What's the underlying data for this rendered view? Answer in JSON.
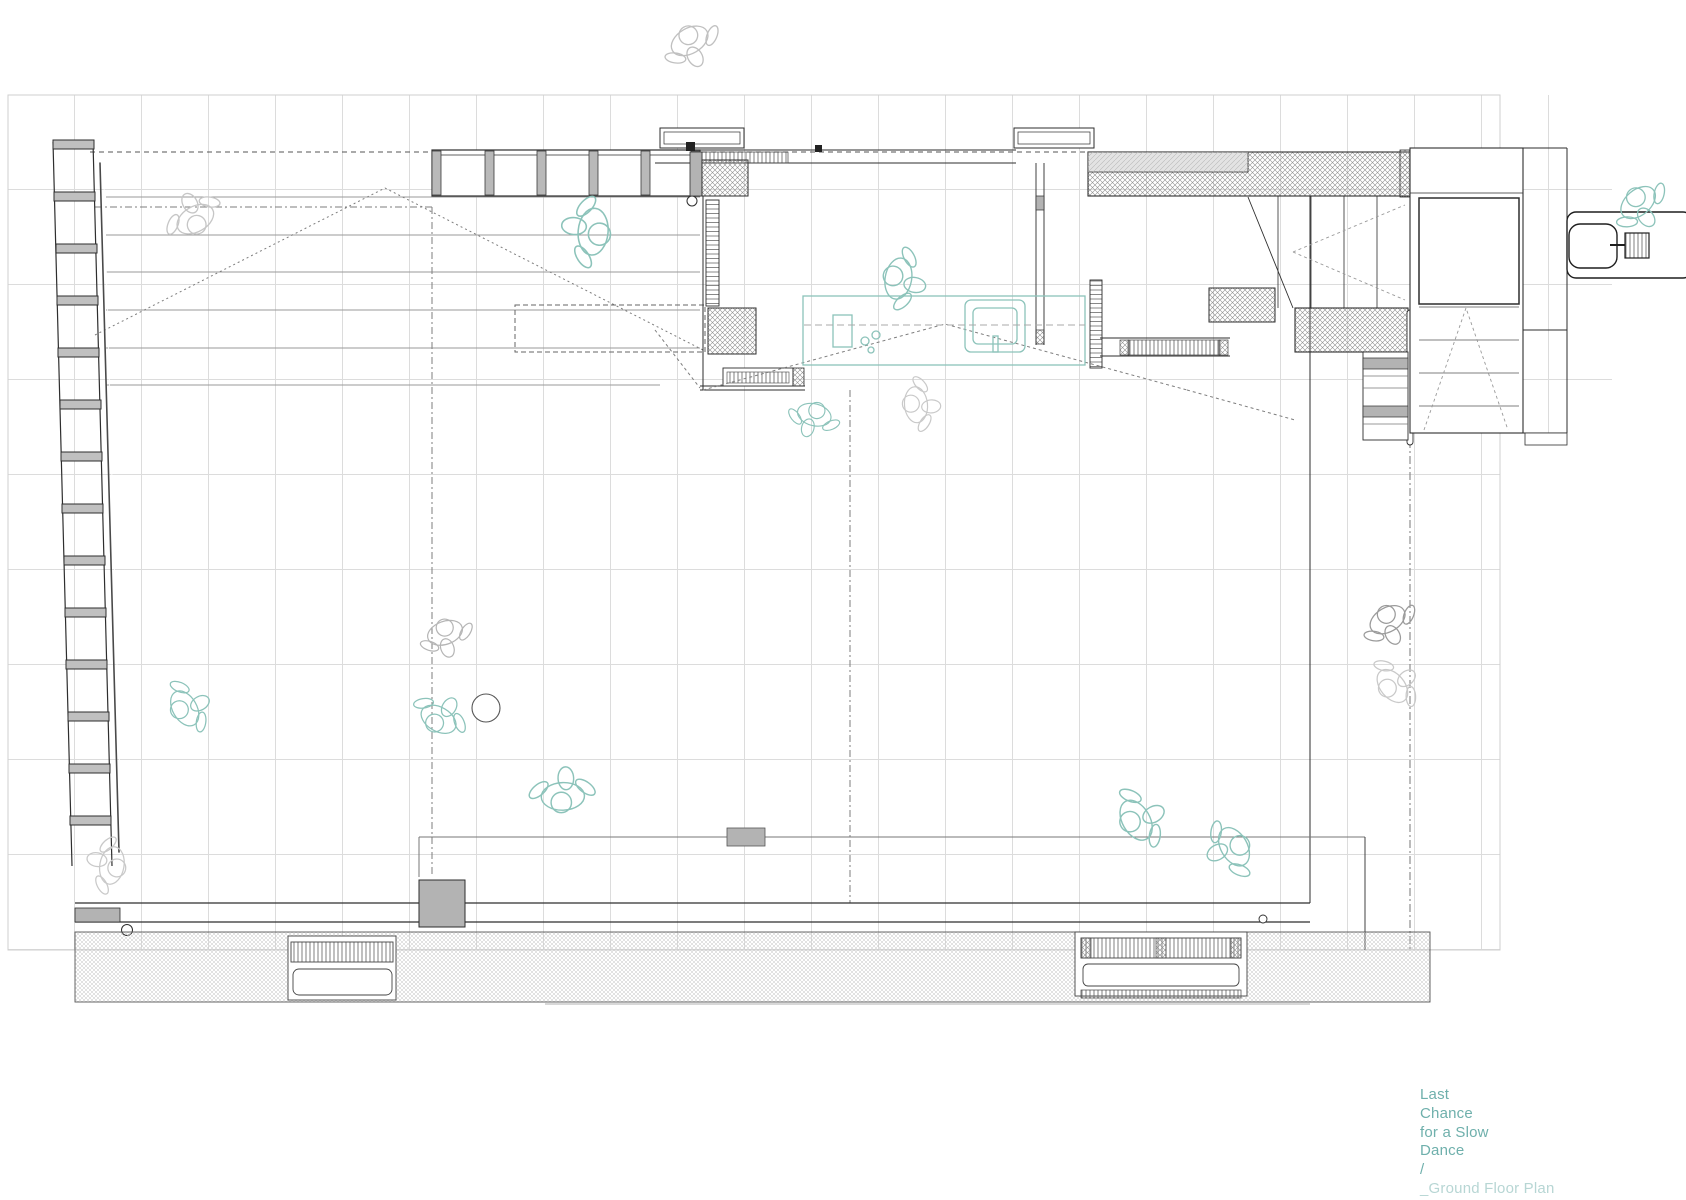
{
  "title_block": {
    "lines": [
      "Last",
      "Chance",
      "for a Slow",
      "Dance",
      "/",
      "_Ground Floor Plan"
    ],
    "accent_color": "#6fb0ac",
    "muted_color": "#b7d6d4"
  },
  "palette": {
    "figure_teal": "#8cc3ba",
    "figure_gray_dark": "#9b9b9b",
    "figure_gray": "#b5b5b5",
    "figure_gray_light": "#c9c9c9",
    "wall_gray_fill": "#b3b3b3",
    "grid_line": "#dcdcdc"
  },
  "plan": {
    "kind": "architectural-ground-floor-plan",
    "ball": {
      "x": 486,
      "y": 708,
      "r": 14
    },
    "figures": [
      {
        "id": "passerby-top",
        "x": 688,
        "y": 38,
        "rot": -30,
        "scale": 1.1,
        "color": "#c0c0c0"
      },
      {
        "id": "terrace-walker",
        "x": 197,
        "y": 222,
        "rot": 150,
        "scale": 1.1,
        "color": "#c6c6c6"
      },
      {
        "id": "dancer-top-left",
        "x": 597,
        "y": 232,
        "rot": 95,
        "scale": 1.3,
        "color": "#8cc3ba"
      },
      {
        "id": "person-at-bar",
        "x": 895,
        "y": 278,
        "rot": -80,
        "scale": 1.15,
        "color": "#8cc3ba"
      },
      {
        "id": "crouching-person",
        "x": 815,
        "y": 412,
        "rot": 15,
        "scale": 0.95,
        "color": "#8cc3ba"
      },
      {
        "id": "gray-partner",
        "x": 913,
        "y": 405,
        "rot": -95,
        "scale": 1.0,
        "color": "#c9c9c9"
      },
      {
        "id": "gray-dancer-mid",
        "x": 444,
        "y": 630,
        "rot": -20,
        "scale": 1.0,
        "color": "#b5b5b5"
      },
      {
        "id": "teal-dancer-mid",
        "x": 437,
        "y": 722,
        "rot": -150,
        "scale": 1.05,
        "color": "#8cc3ba"
      },
      {
        "id": "teal-dancer-left",
        "x": 182,
        "y": 710,
        "rot": -120,
        "scale": 1.05,
        "color": "#8cc3ba"
      },
      {
        "id": "sitting-on-bench",
        "x": 563,
        "y": 800,
        "rot": 178,
        "scale": 1.2,
        "color": "#8cc3ba"
      },
      {
        "id": "gray-corner-person",
        "x": 115,
        "y": 866,
        "rot": 100,
        "scale": 1.05,
        "color": "#c9c9c9"
      },
      {
        "id": "dancing-pair-a",
        "x": 1133,
        "y": 822,
        "rot": -120,
        "scale": 1.2,
        "color": "#8cc3ba"
      },
      {
        "id": "dancing-pair-b",
        "x": 1237,
        "y": 845,
        "rot": 60,
        "scale": 1.15,
        "color": "#8cc3ba"
      },
      {
        "id": "sidewalk-person-a",
        "x": 1386,
        "y": 617,
        "rot": -30,
        "scale": 1.05,
        "color": "#9b9b9b"
      },
      {
        "id": "sidewalk-person-b",
        "x": 1390,
        "y": 688,
        "rot": -130,
        "scale": 1.05,
        "color": "#c9c9c9"
      },
      {
        "id": "person-at-desk",
        "x": 1636,
        "y": 200,
        "rot": -40,
        "scale": 1.1,
        "color": "#8cc3ba"
      }
    ]
  }
}
